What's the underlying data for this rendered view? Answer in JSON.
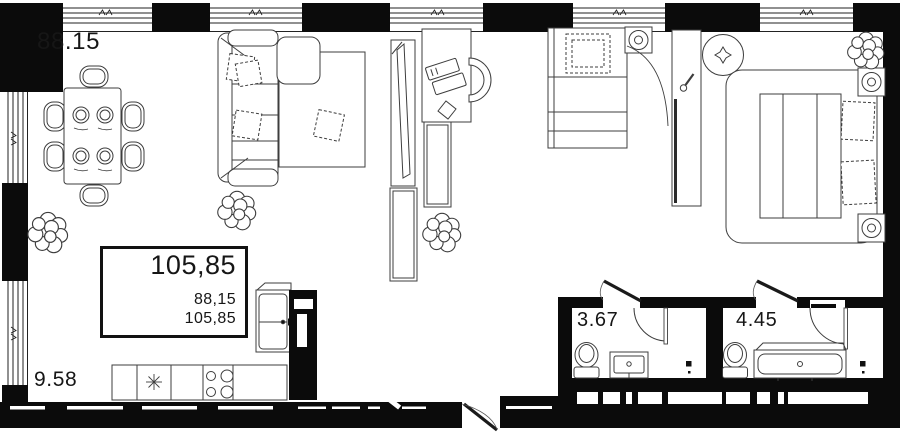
{
  "colors": {
    "wall": "#0b0b0b",
    "furniture_line": "#3d3d3d",
    "text": "#161616",
    "background": "#ffffff"
  },
  "areas": {
    "living_room": "88.15",
    "kitchen": "9.58",
    "bathroom_small": "3.67",
    "bathroom_large": "4.45"
  },
  "area_summary": {
    "total": "105,85",
    "living_total": "88,15",
    "overall_total": "105,85"
  }
}
